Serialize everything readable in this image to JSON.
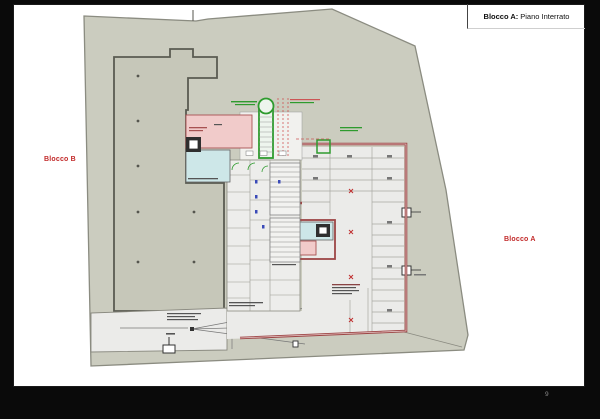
{
  "window": {
    "background_color": "#0a0a0a",
    "page_number": "9"
  },
  "title_block": {
    "block_label": "Blocco A:",
    "title": "Piano Interrato"
  },
  "plan": {
    "labels": {
      "blocco_b": "Blocco B",
      "blocco_a": "Blocco A"
    },
    "colors": {
      "site_fill": "#cbccbf",
      "site_stroke": "#8b8c81",
      "building_fill": "#c6c7b9",
      "building_stroke": "#55564e",
      "garage_floor": "#ebebe9",
      "wall_red": "#9d4545",
      "room_pink": "#f1cbca",
      "room_cyan": "#cde7e8",
      "ramp_green": "#2e9b2e",
      "marker_red": "#c03030",
      "label_red": "#c22a2a",
      "annotation_blue": "#3a4ab8"
    }
  }
}
